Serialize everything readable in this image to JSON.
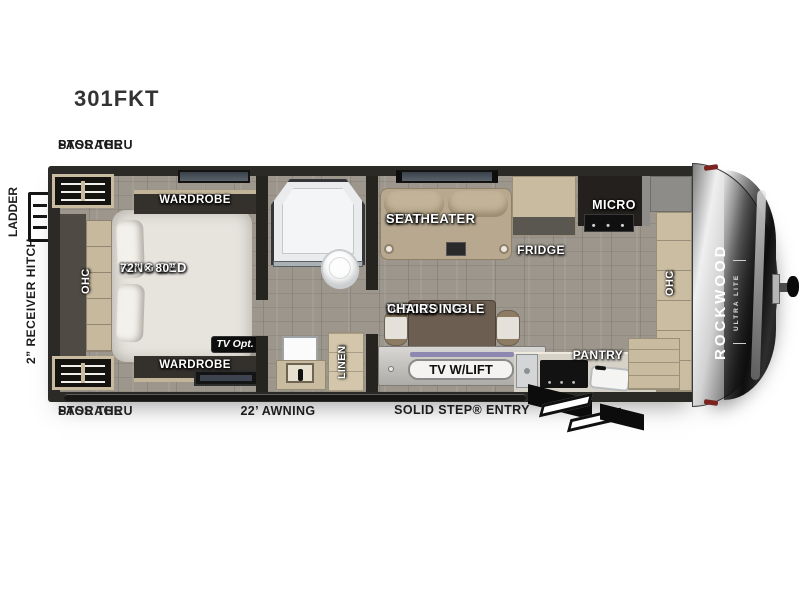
{
  "model": "301FKT",
  "brand": {
    "name": "ROCKWOOD",
    "trim": "ULTRA LITE"
  },
  "colors": {
    "wall": "#2c2a26",
    "floor_wood": "#9c968c",
    "cabinet_tan": "#c9bb9f",
    "theater_tan": "#b7a88f",
    "cap_silver": "#d2d2d2",
    "label_white": "#ffffff",
    "label_black": "#1c1c1c"
  },
  "exterior": {
    "pass_thru_top": [
      "PASS THRU",
      "STORAGE"
    ],
    "pass_thru_bottom": [
      "PASS THRU",
      "STORAGE"
    ],
    "ladder": "LADDER",
    "receiver_hitch": "2” RECEIVER HITCH",
    "awning": "22’ AWNING",
    "entry": "SOLID STEP® ENTRY"
  },
  "bedroom": {
    "ohc": "OHC",
    "wardrobe_top": "WARDROBE",
    "wardrobe_bottom": "WARDROBE",
    "bed": [
      "KING BED",
      "72” × 80”"
    ],
    "tv_opt": "TV Opt."
  },
  "bath": {
    "linen": "LINEN"
  },
  "living": {
    "theater": [
      "67” THEATER",
      "SEAT"
    ],
    "flip_table": [
      "FLIP-UP TABLE",
      "W/FOLDING",
      "CHAIRS"
    ],
    "tv_lift": "TV W/LIFT"
  },
  "kitchen": {
    "fridge": "FRIDGE",
    "micro": "MICRO",
    "pantry": "PANTRY",
    "ohc": "OHC"
  }
}
